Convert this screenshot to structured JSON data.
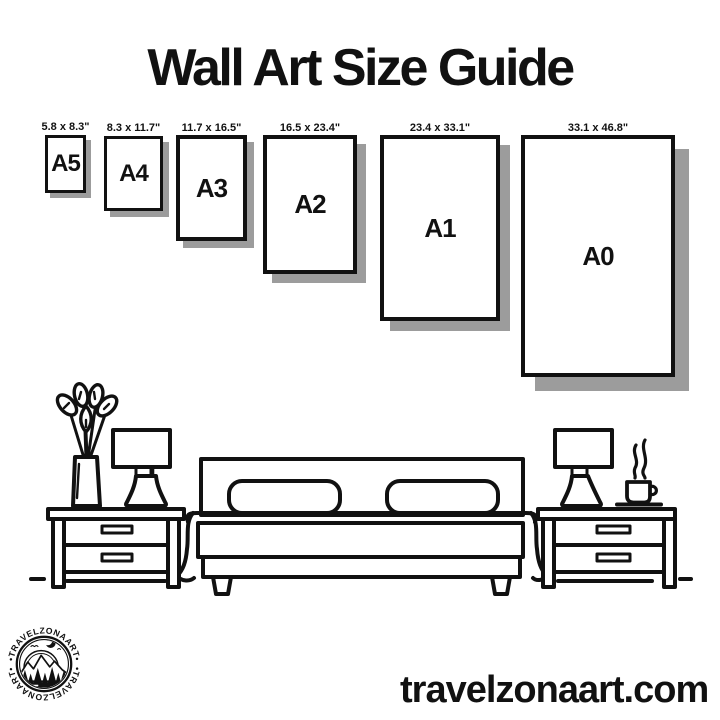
{
  "title": "Wall Art Size Guide",
  "sizes": [
    {
      "name": "A5",
      "dims": "5.8 x 8.3\""
    },
    {
      "name": "A4",
      "dims": "8.3 x 11.7\""
    },
    {
      "name": "A3",
      "dims": "11.7 x 16.5\""
    },
    {
      "name": "A2",
      "dims": "16.5 x 23.4\""
    },
    {
      "name": "A1",
      "dims": "23.4 x 33.1\""
    },
    {
      "name": "A0",
      "dims": "33.1 x 46.8\""
    }
  ],
  "footer": {
    "website": "travelzonaart.com"
  },
  "logo": {
    "brand": "TRAVELZONAART",
    "arc_text_top": "•TRAVELZONAART•",
    "arc_text_bottom": "•TRAVELZONAART•"
  },
  "colors": {
    "ink": "#111111",
    "shadow": "#9c9c9c",
    "background": "#ffffff"
  }
}
